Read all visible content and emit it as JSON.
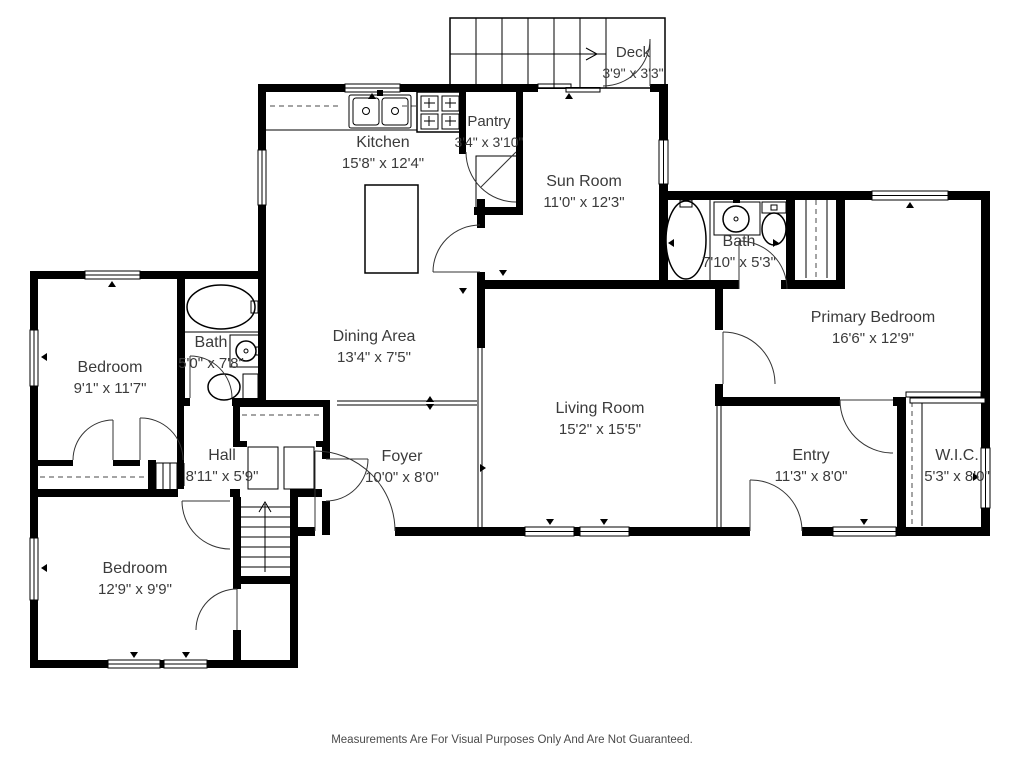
{
  "floor_plan": {
    "rooms": [
      {
        "id": "deck",
        "name": "Deck",
        "dims": "3'9\" x 3'3\""
      },
      {
        "id": "kitchen",
        "name": "Kitchen",
        "dims": "15'8\" x 12'4\""
      },
      {
        "id": "pantry",
        "name": "Pantry",
        "dims": "3'4\" x 3'10\""
      },
      {
        "id": "sun-room",
        "name": "Sun Room",
        "dims": "11'0\" x 12'3\""
      },
      {
        "id": "bath-upper",
        "name": "Bath",
        "dims": "7'10\" x 5'3\""
      },
      {
        "id": "primary-bedroom",
        "name": "Primary Bedroom",
        "dims": "16'6\" x 12'9\""
      },
      {
        "id": "bedroom-left",
        "name": "Bedroom",
        "dims": "9'1\" x 11'7\""
      },
      {
        "id": "bath-left",
        "name": "Bath",
        "dims": "5'0\" x 7'8\""
      },
      {
        "id": "dining-area",
        "name": "Dining Area",
        "dims": "13'4\" x 7'5\""
      },
      {
        "id": "living-room",
        "name": "Living Room",
        "dims": "15'2\" x 15'5\""
      },
      {
        "id": "hall",
        "name": "Hall",
        "dims": "8'11\" x 5'9\""
      },
      {
        "id": "foyer",
        "name": "Foyer",
        "dims": "10'0\" x 8'0\""
      },
      {
        "id": "entry",
        "name": "Entry",
        "dims": "11'3\" x 8'0\""
      },
      {
        "id": "wic",
        "name": "W.I.C.",
        "dims": "5'3\" x 8'0\""
      },
      {
        "id": "bedroom-lower",
        "name": "Bedroom",
        "dims": "12'9\" x 9'9\""
      }
    ],
    "disclaimer": "Measurements Are For Visual Purposes Only And Are Not Guaranteed.",
    "colors": {
      "wall": "#000000",
      "background": "#ffffff",
      "label": "#3b3b3b"
    }
  }
}
